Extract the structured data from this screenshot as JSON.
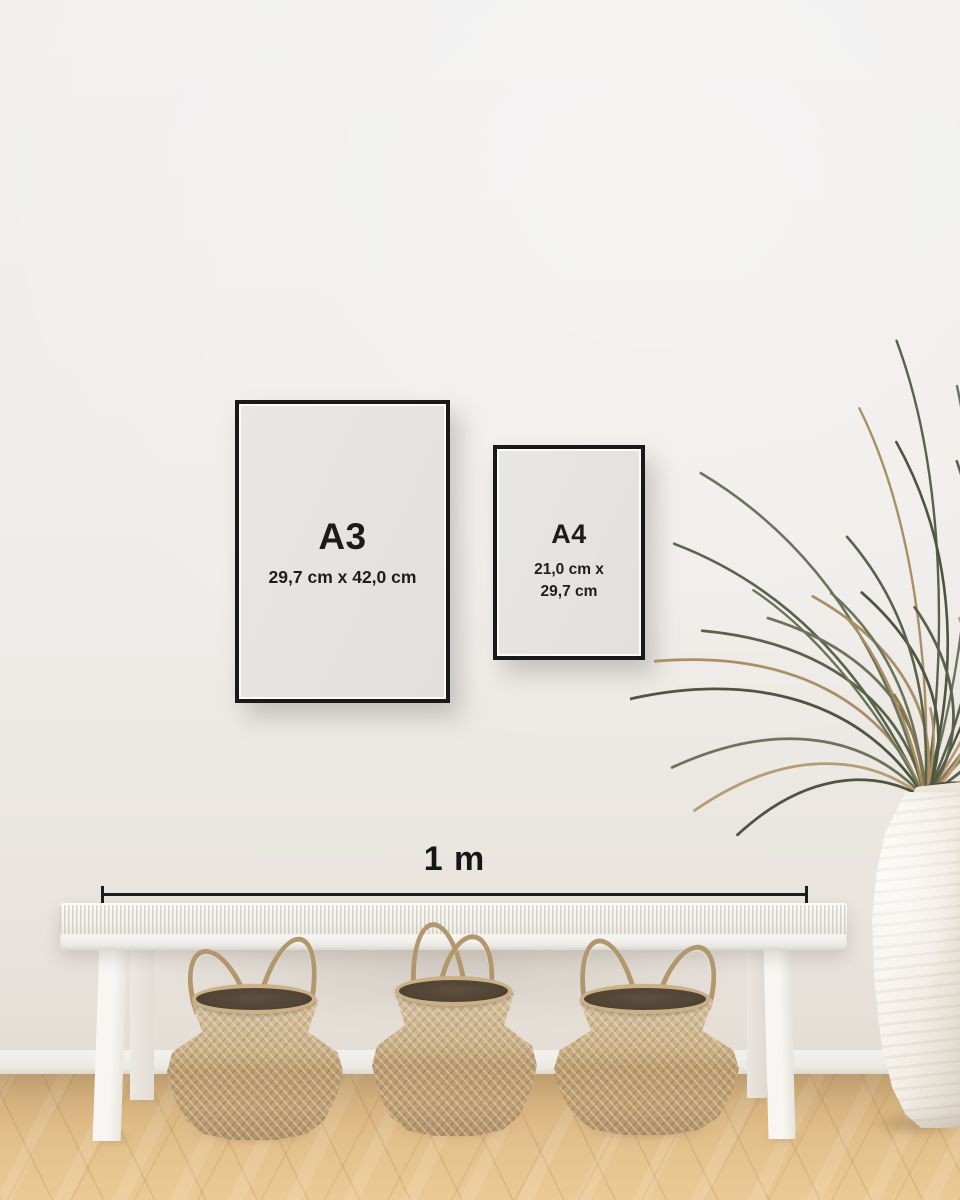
{
  "scene": {
    "frames": {
      "a3": {
        "label": "A3",
        "size": "29,7 cm x 42,0 cm"
      },
      "a4": {
        "label": "A4",
        "size_line1": "21,0 cm x",
        "size_line2": "29,7 cm"
      }
    },
    "scale_bar": {
      "label": "1 m"
    },
    "colors": {
      "wall": "#efedea",
      "floor_wood": "#ddb985",
      "frame_border": "#191919",
      "frame_paper": "#e6e4e2",
      "text": "#1c1c1c",
      "basket_weave": "#c5a97e",
      "bench_white": "#f6f5f2",
      "plant_green": "#5a624a",
      "plant_dry": "#aa8f64",
      "vase_white": "#f2eee7"
    }
  }
}
